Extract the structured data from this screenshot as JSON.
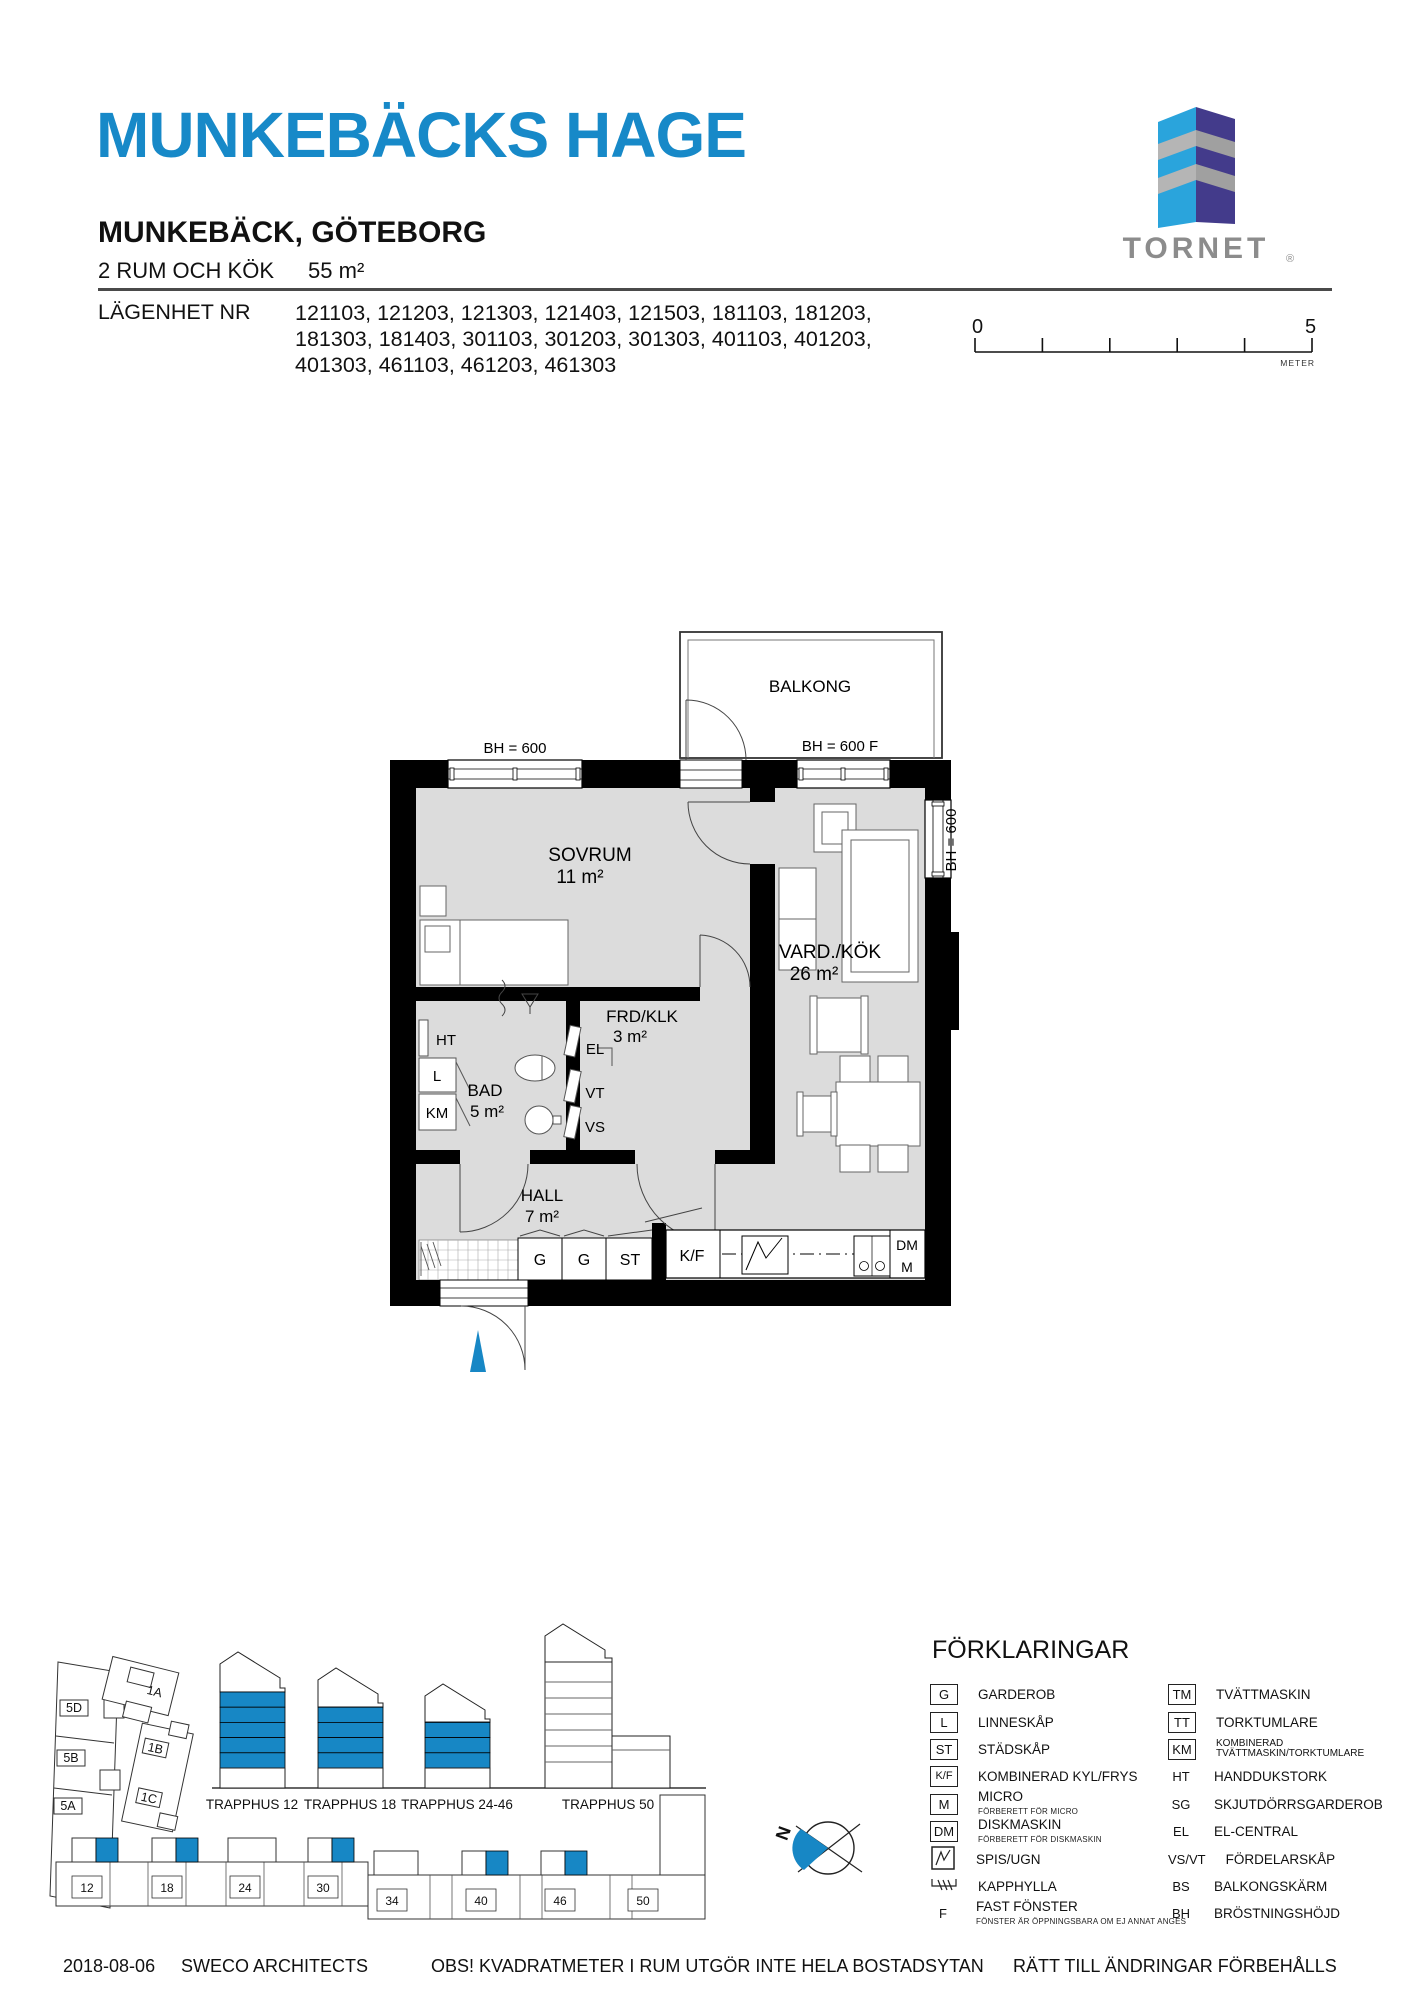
{
  "header": {
    "title": "MUNKEBÄCKS HAGE",
    "subtitle": "MUNKEBÄCK, GÖTEBORG",
    "type_line": "2 RUM OCH KÖK",
    "area": "55 m²",
    "apartment_label": "LÄGENHET NR",
    "apartment_numbers": [
      "121103, 121203, 121303, 121403, 121503, 181103, 181203,",
      "181303, 181403, 301103, 301203, 301303, 401103, 401203,",
      "401303, 461103, 461203, 461303"
    ]
  },
  "logo": {
    "brand": "TORNET",
    "reg": "®"
  },
  "scalebar": {
    "start": "0",
    "end": "5",
    "unit": "METER"
  },
  "floorplan": {
    "balcony": "BALKONG",
    "bh_left": "BH = 600",
    "bh_balcony": "BH = 600 F",
    "bh_right": "BH = 600",
    "rooms": {
      "sovrum": {
        "name": "SOVRUM",
        "area": "11 m²"
      },
      "vard": {
        "name": "VARD./KÖK",
        "area": "26 m²"
      },
      "frd": {
        "name": "FRD/KLK",
        "area": "3 m²"
      },
      "bad": {
        "name": "BAD",
        "area": "5 m²"
      },
      "hall": {
        "name": "HALL",
        "area": "7 m²"
      }
    },
    "labels": {
      "ht": "HT",
      "l": "L",
      "km": "KM",
      "el": "EL",
      "vt": "VT",
      "vs": "VS",
      "g1": "G",
      "g2": "G",
      "st": "ST",
      "kf": "K/F",
      "dm": "DM",
      "m": "M"
    }
  },
  "site": {
    "block_labels": [
      "5D",
      "5B",
      "5A",
      "1A",
      "1B",
      "1C"
    ],
    "buildings": [
      {
        "label": "TRAPPHUS 12",
        "blue_floors": 5
      },
      {
        "label": "TRAPPHUS 18",
        "blue_floors": 4
      },
      {
        "label": "TRAPPHUS 24-46",
        "blue_floors": 3
      },
      {
        "label": "TRAPPHUS 50",
        "blue_floors": 0
      }
    ],
    "strip_numbers": [
      "12",
      "18",
      "24",
      "30",
      "34",
      "40",
      "46",
      "50"
    ],
    "compass_n": "N"
  },
  "legend": {
    "title": "FÖRKLARINGAR",
    "col1": [
      {
        "sym": "G",
        "text": "GARDEROB"
      },
      {
        "sym": "L",
        "text": "LINNESKÅP"
      },
      {
        "sym": "ST",
        "text": "STÄDSKÅP"
      },
      {
        "sym": "K/F",
        "text": "KOMBINERAD KYL/FRYS"
      },
      {
        "sym": "M",
        "text": "MICRO",
        "sub": "FÖRBERETT FÖR MICRO"
      },
      {
        "sym": "DM",
        "text": "DISKMASKIN",
        "sub": "FÖRBERETT FÖR DISKMASKIN"
      },
      {
        "sym": "spis-icon",
        "text": "SPIS/UGN"
      },
      {
        "sym": "kapphylla-icon",
        "text": "KAPPHYLLA"
      },
      {
        "sym": "F",
        "text": "FAST FÖNSTER",
        "sub": "FÖNSTER ÄR ÖPPNINGSBARA OM EJ ANNAT ANGES"
      }
    ],
    "col2": [
      {
        "sym": "TM",
        "text": "TVÄTTMASKIN"
      },
      {
        "sym": "TT",
        "text": "TORKTUMLARE"
      },
      {
        "sym": "KM",
        "text": "KOMBINERAD",
        "text2": "TVÄTTMASKIN/TORKTUMLARE"
      },
      {
        "sym": "HT",
        "text": "HANDDUKSTORK"
      },
      {
        "sym": "SG",
        "text": "SKJUTDÖRRSGARDEROB"
      },
      {
        "sym": "EL",
        "text": "EL-CENTRAL"
      },
      {
        "sym": "VS/VT",
        "text": "FÖRDELARSKÅP"
      },
      {
        "sym": "BS",
        "text": "BALKONGSKÄRM"
      },
      {
        "sym": "BH",
        "text": "BRÖSTNINGSHÖJD"
      }
    ]
  },
  "footer": {
    "date": "2018-08-06",
    "architect": "SWECO ARCHITECTS",
    "note": "OBS! KVADRATMETER I RUM UTGÖR INTE HELA BOSTADSYTAN",
    "rights": "RÄTT TILL ÄNDRINGAR FÖRBEHÅLLS"
  },
  "colors": {
    "accent": "#1787C5",
    "logo_blue": "#2AA4DC",
    "logo_purple": "#433B8B",
    "logo_gray": "#ACACAC",
    "logo_text": "#8C8C8C",
    "room_fill": "#DCDCDC"
  }
}
